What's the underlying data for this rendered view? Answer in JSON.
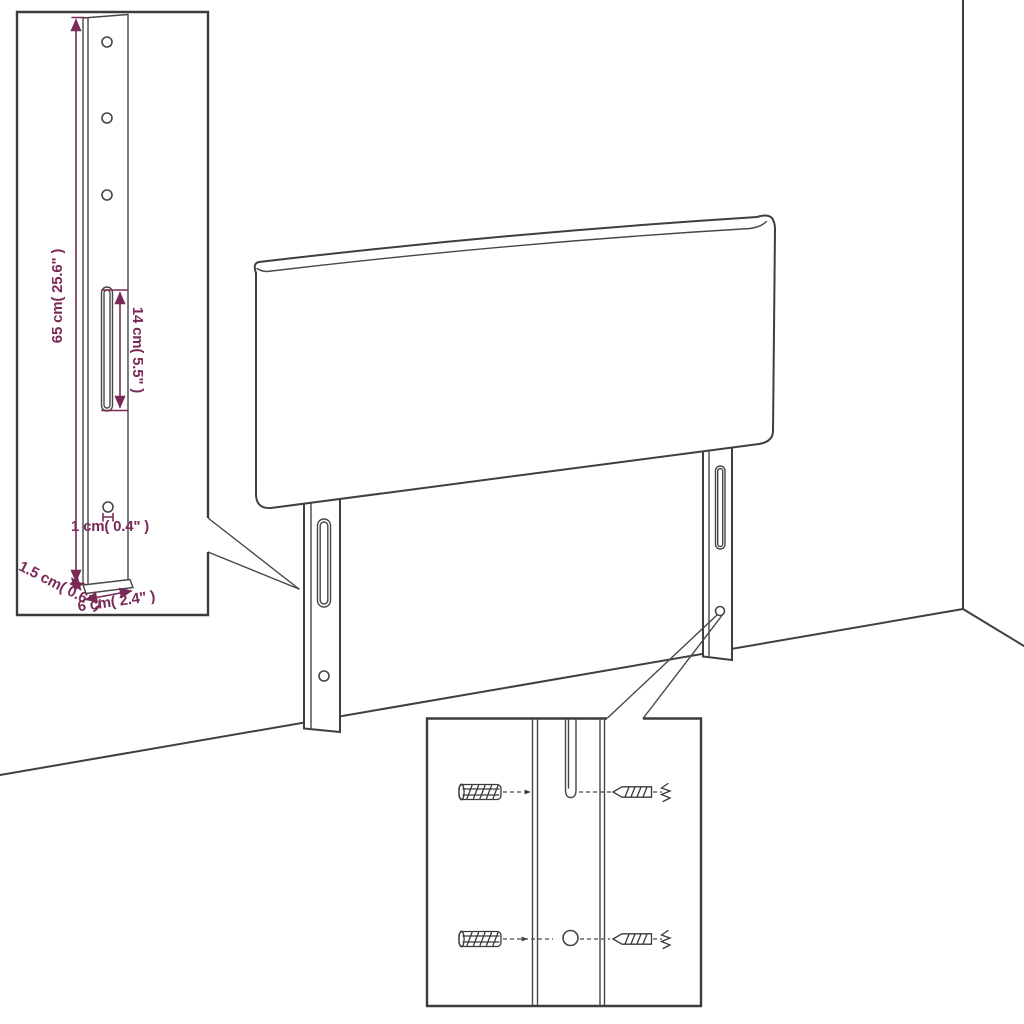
{
  "diagram": {
    "type": "furniture-assembly-diagram",
    "subject": "upholstered headboard with two mounting legs, wall corner backdrop, two magnified detail insets"
  },
  "colors": {
    "background": "#ffffff",
    "line": "#3f3f3f",
    "accent_dimension": "#7a2a56"
  },
  "annotations": {
    "height": "65 cm( 25.6\" )",
    "slot_length": "14 cm( 5.5\" )",
    "hole_diameter": "1 cm( 0.4\" )",
    "thickness": "1.5 cm( 0.6\" )",
    "width": "6 cm( 2.4\" )"
  }
}
